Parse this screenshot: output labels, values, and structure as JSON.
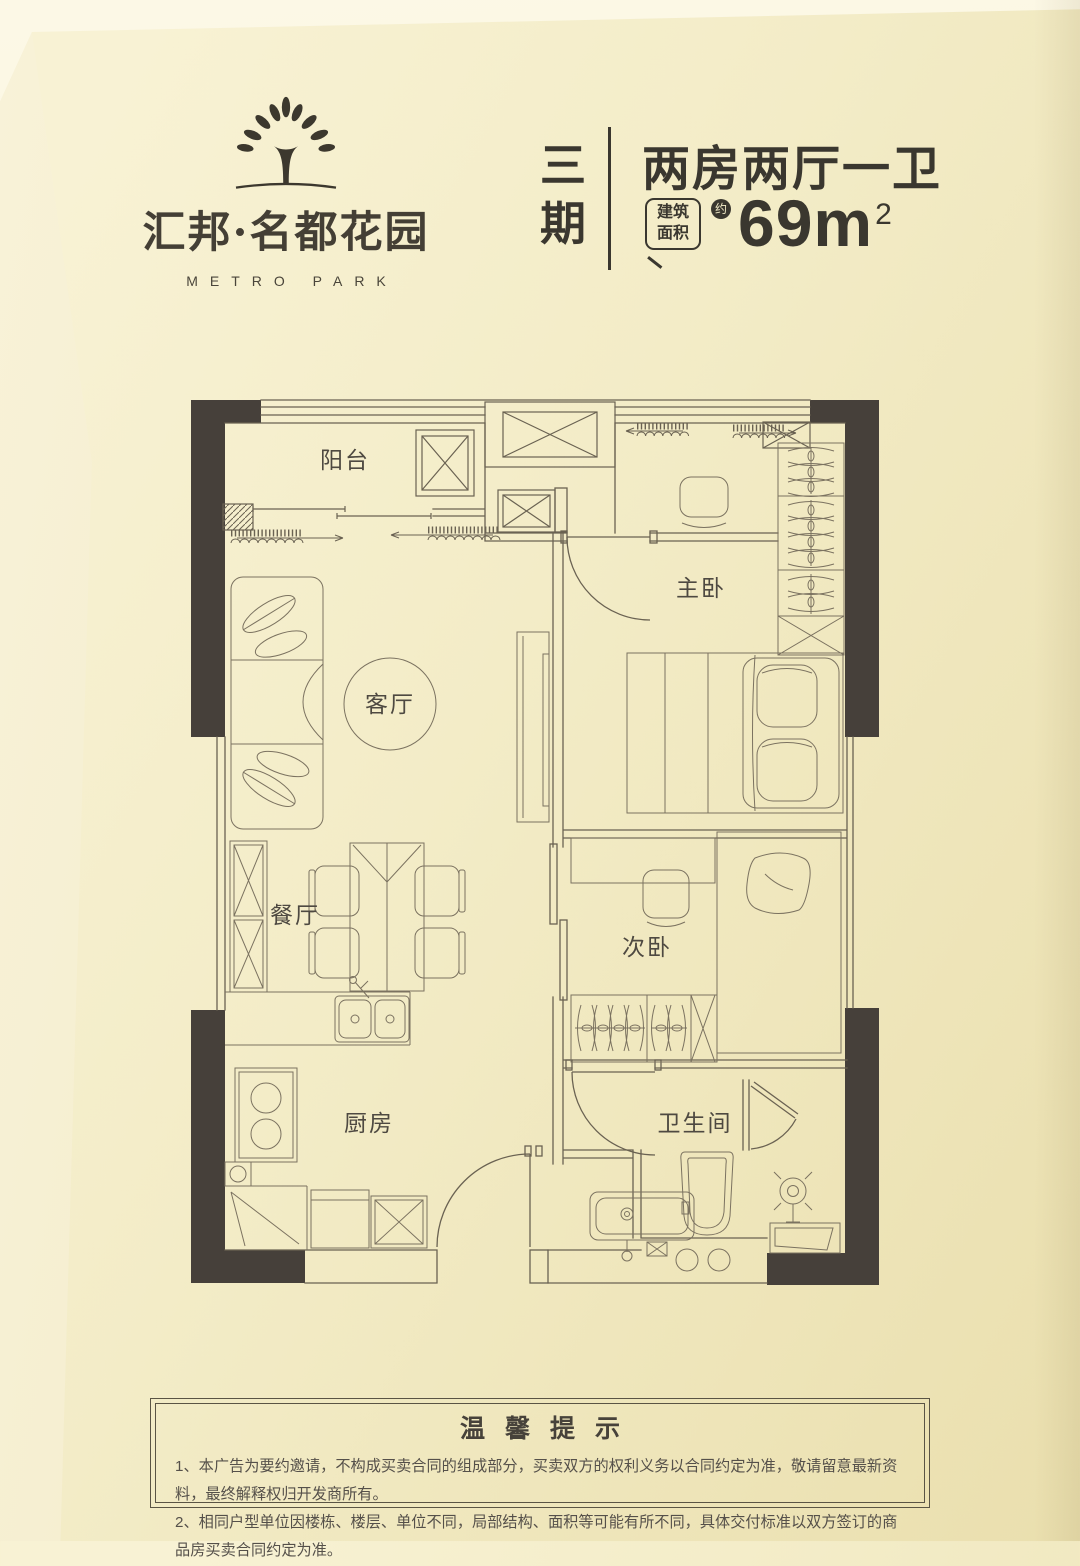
{
  "brand": {
    "name": "汇邦·名都花园",
    "subtitle": "METRO PARK"
  },
  "header": {
    "phase": "三期",
    "title": "两房两厅一卫",
    "area_tag_line1": "建筑",
    "area_tag_line2": "面积",
    "area_approx": "约",
    "area_value": "69m",
    "area_sup": "2"
  },
  "floorplan": {
    "rooms": [
      "阳台",
      "客厅",
      "主卧",
      "餐厅",
      "次卧",
      "厨房",
      "卫生间"
    ]
  },
  "notice": {
    "title": "温馨提示",
    "items": [
      "1、本广告为要约邀请，不构成买卖合同的组成部分，买卖双方的权利义务以合同约定为准，敬请留意最新资料，最终解释权归开发商所有。",
      "2、相同户型单位因楼栋、楼层、单位不同，局部结构、面积等可能有所不同，具体交付标准以双方签订的商品房买卖合同约定为准。"
    ]
  },
  "colors": {
    "ink": "#3a372f",
    "wall_dark": "#46403a",
    "line": "#6a6252",
    "background": "#f3ecc7"
  }
}
